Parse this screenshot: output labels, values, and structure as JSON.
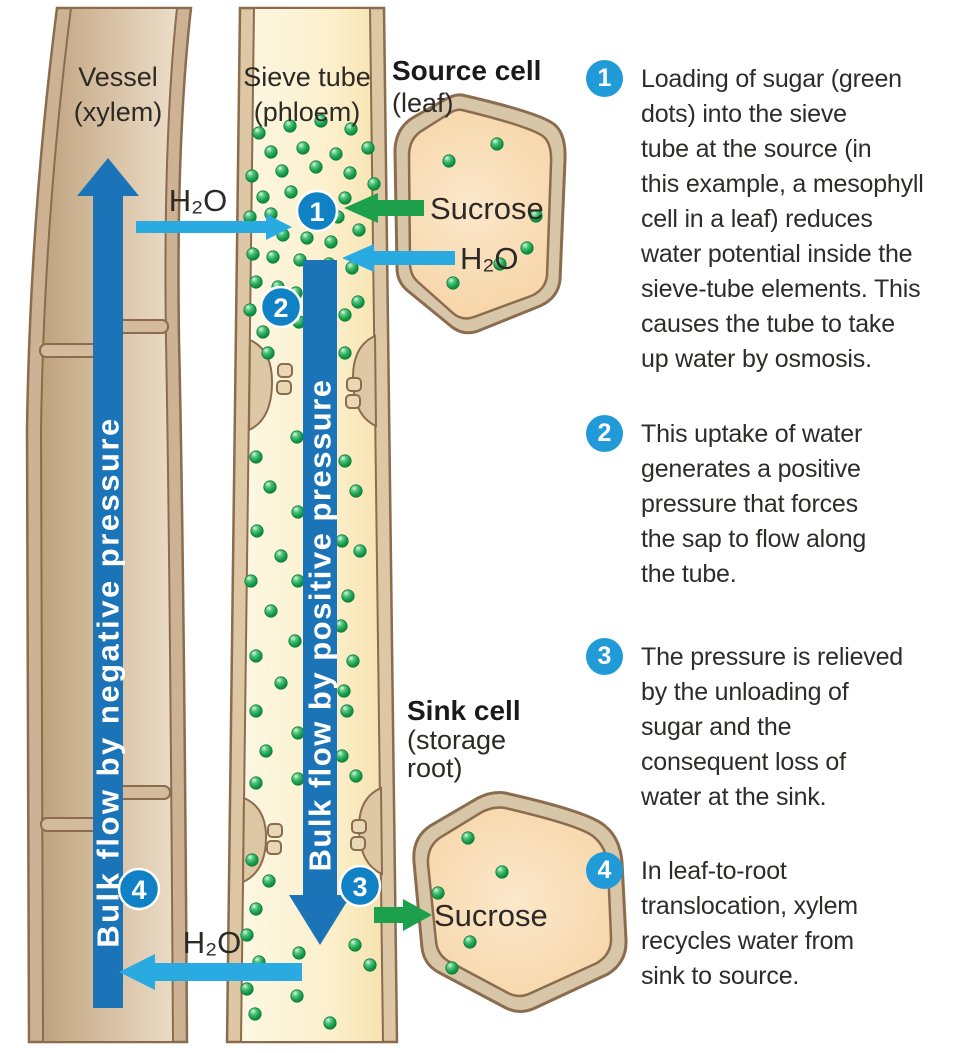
{
  "diagram": {
    "labels": {
      "vessel_line1": "Vessel",
      "vessel_line2": "(xylem)",
      "sieve_line1": "Sieve tube",
      "sieve_line2": "(phloem)",
      "source_title": "Source cell",
      "source_sub": "(leaf)",
      "sink_title": "Sink cell",
      "sink_sub_line1": "(storage",
      "sink_sub_line2": "root)",
      "h2o_top": "H₂O",
      "h2o_source": "H₂O",
      "h2o_bottom": "H₂O",
      "sucrose_source": "Sucrose",
      "sucrose_sink": "Sucrose",
      "xylem_arrow_text": "Bulk flow by negative pressure",
      "phloem_arrow_text": "Bulk flow by positive pressure"
    },
    "markers": [
      "1",
      "2",
      "3",
      "4"
    ],
    "colors": {
      "bulk_arrow_blue": "#1b74b8",
      "water_arrow_blue": "#29abe2",
      "sucrose_green": "#1da04b",
      "marker_blue": "#1081c4",
      "list_marker_blue": "#219bd8"
    }
  },
  "annotations": [
    {
      "number": "1",
      "lines": [
        "Loading of sugar (green",
        "dots) into the sieve",
        "tube at the source (in",
        "this example, a mesophyll",
        "cell in a leaf) reduces",
        "water potential inside the",
        "sieve-tube elements. This",
        "causes the tube to take",
        "up water by osmosis."
      ]
    },
    {
      "number": "2",
      "lines": [
        "This uptake of water",
        "generates a positive",
        "pressure that forces",
        "the sap to flow along",
        "the tube."
      ]
    },
    {
      "number": "3",
      "lines": [
        "The pressure is relieved",
        "by the unloading of",
        "sugar and the",
        "consequent loss of",
        "water at the sink."
      ]
    },
    {
      "number": "4",
      "lines": [
        "In leaf-to-root",
        "translocation, xylem",
        "recycles water from",
        "sink to source."
      ]
    }
  ]
}
